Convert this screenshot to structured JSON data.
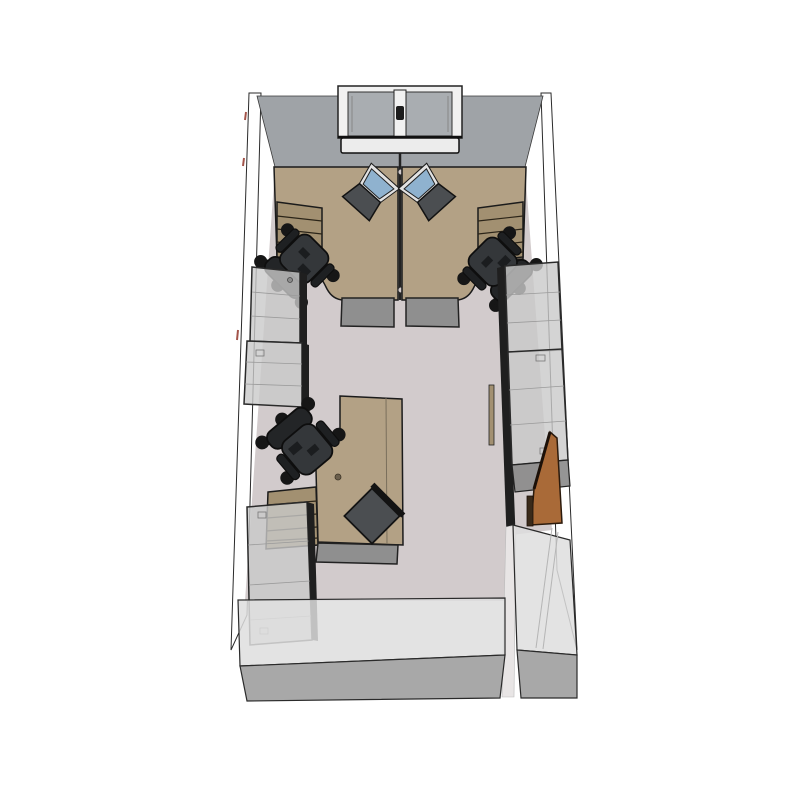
{
  "scene": {
    "type": "3d-room-render",
    "view": "top-down perspective view of a small office",
    "objects": [
      {
        "id": "back-wall",
        "label": "back wall"
      },
      {
        "id": "window",
        "label": "double-pane window with sill and handle",
        "wall": "back"
      },
      {
        "id": "left-wall",
        "label": "left wall"
      },
      {
        "id": "right-wall",
        "label": "right wall"
      },
      {
        "id": "front-wall",
        "label": "front wall with door opening"
      },
      {
        "id": "floor",
        "label": "room floor"
      },
      {
        "id": "workstation-left",
        "label": "corner desk with drawer return, mobile pedestal, task chair, open laptop"
      },
      {
        "id": "workstation-right",
        "label": "mirrored corner desk with drawer return, mobile pedestal, task chair, open laptop"
      },
      {
        "id": "desk-divider",
        "label": "center divider screen between paired desks"
      },
      {
        "id": "workstation-bottom",
        "label": "corner desk with drawer return, mobile pedestal, task chair, closed laptop"
      },
      {
        "id": "cabinet-left-upper",
        "label": "tall storage cabinet, left wall"
      },
      {
        "id": "cabinet-left-lower",
        "label": "tall storage cabinet, left wall"
      },
      {
        "id": "cabinet-right-upper",
        "label": "tall storage cabinet, right wall"
      },
      {
        "id": "cabinet-right-lower",
        "label": "tall storage cabinet, right wall"
      },
      {
        "id": "cabinet-corner",
        "label": "storage cabinet, bottom-left corner"
      },
      {
        "id": "door",
        "label": "open wooden door, bottom-right corner"
      }
    ],
    "furniture_counts": {
      "desks": 3,
      "chairs": 3,
      "laptops": 3,
      "cabinets": 5,
      "windows": 1,
      "doors": 1
    }
  },
  "colors": {
    "background": "#ffffff",
    "wall_back": "#9fa3a7",
    "window_glass": "#a9adb1",
    "window_frame": "#f1f1f1",
    "sill": "#ececec",
    "floor": "#d2cbcc",
    "desk": "#b3a185",
    "desk_drawers": "#a29071",
    "pedestal": "#8f8f8f",
    "cabinet": "#c9c9c9",
    "cabinet_edge": "#1f1f1f",
    "chair_seat": "#34373a",
    "chair_back": "#232527",
    "laptop_screen": "#8fb2cf",
    "laptop_body": "#4b4e51",
    "door": "#a96a38",
    "front_wall": "#dedede",
    "front_wall_base": "#a8a8a8",
    "outline": "#1a1a1a"
  }
}
